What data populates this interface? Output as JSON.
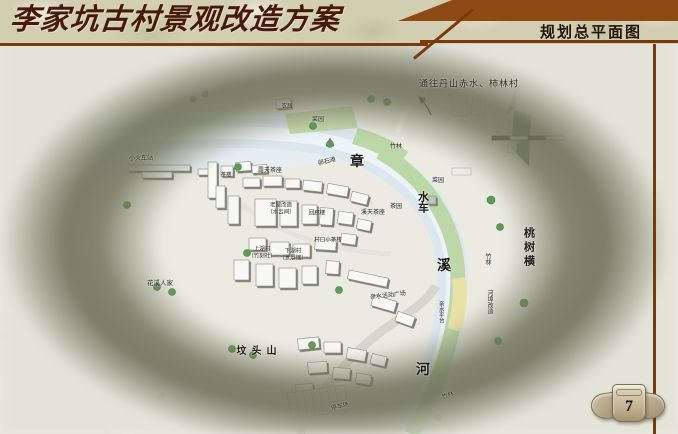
{
  "header": {
    "title": "李家坑古村景观改造方案",
    "section_title": "规划总平面图"
  },
  "page_number": "7",
  "map": {
    "river_name": "章溪河",
    "route_note": "通往丹山赤水、柿林村",
    "labels": [
      {
        "t": "通往丹山赤水、柿林村",
        "x": 469,
        "y": 84,
        "s": 9,
        "ls": 1
      },
      {
        "t": "小火车站",
        "x": 141,
        "y": 159,
        "s": 6
      },
      {
        "t": "茶楼",
        "x": 226,
        "y": 176,
        "s": 5.5
      },
      {
        "t": "露天茶座",
        "x": 270,
        "y": 171,
        "s": 6
      },
      {
        "t": "卵石滩",
        "x": 327,
        "y": 162,
        "s": 6,
        "r": -14
      },
      {
        "t": "农居",
        "x": 287,
        "y": 107,
        "s": 5.5
      },
      {
        "t": "菜园",
        "x": 318,
        "y": 120,
        "s": 6
      },
      {
        "t": "竹林",
        "x": 396,
        "y": 147,
        "s": 6
      },
      {
        "t": "章",
        "x": 357,
        "y": 163,
        "s": 14,
        "big": true
      },
      {
        "t": "菜园",
        "x": 438,
        "y": 181,
        "s": 6
      },
      {
        "t": "水车",
        "x": 422,
        "y": 202,
        "s": 11,
        "v": true,
        "big": true
      },
      {
        "t": "茶园",
        "x": 396,
        "y": 207,
        "s": 6
      },
      {
        "t": "溪天茶座",
        "x": 373,
        "y": 213,
        "s": 6
      },
      {
        "t": "老屋改造",
        "x": 281,
        "y": 206,
        "s": 5.5
      },
      {
        "t": "（水云间）",
        "x": 281,
        "y": 213,
        "s": 5.5
      },
      {
        "t": "回廊楼",
        "x": 317,
        "y": 214,
        "s": 5.5
      },
      {
        "t": "村口小茶楼",
        "x": 328,
        "y": 241,
        "s": 5.5
      },
      {
        "t": "上湖村",
        "x": 262,
        "y": 250,
        "s": 5.5
      },
      {
        "t": "（竹刻社）",
        "x": 262,
        "y": 257,
        "s": 5.5
      },
      {
        "t": "下湖村",
        "x": 293,
        "y": 252,
        "s": 5.5
      },
      {
        "t": "（景展馆）",
        "x": 293,
        "y": 259,
        "s": 5.5
      },
      {
        "t": "桃树横",
        "x": 528,
        "y": 248,
        "s": 11,
        "v": true,
        "big": true,
        "ls": 3
      },
      {
        "t": "竹林",
        "x": 487,
        "y": 259,
        "s": 6,
        "v": true
      },
      {
        "t": "溪",
        "x": 444,
        "y": 267,
        "s": 14,
        "big": true
      },
      {
        "t": "河埠改造",
        "x": 489,
        "y": 302,
        "s": 6,
        "v": true
      },
      {
        "t": "亲水平台",
        "x": 440,
        "y": 312,
        "s": 5.5,
        "v": true
      },
      {
        "t": "亲水活动广场",
        "x": 388,
        "y": 296,
        "s": 6,
        "r": -6
      },
      {
        "t": "花溪人家",
        "x": 160,
        "y": 284,
        "s": 6.5
      },
      {
        "t": "坟头山",
        "x": 259,
        "y": 352,
        "s": 10,
        "big": true,
        "ls": 5
      },
      {
        "t": "河",
        "x": 423,
        "y": 371,
        "s": 14,
        "big": true
      },
      {
        "t": "停车场",
        "x": 340,
        "y": 407,
        "s": 6,
        "r": -12
      },
      {
        "t": "竹林",
        "x": 448,
        "y": 396,
        "s": 6,
        "r": -20
      }
    ]
  }
}
